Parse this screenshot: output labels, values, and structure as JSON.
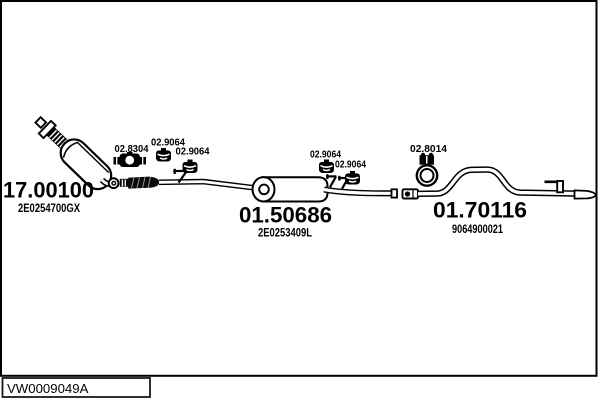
{
  "diagram": {
    "kind": "exhaust-system-parts-diagram",
    "background": "#ffffff",
    "line_color": "#000000",
    "vehicle_code": "VW0009049A",
    "parts": [
      {
        "number": "17.00100",
        "oem_ref": "2E0254700GX",
        "component": "catalytic-converter"
      },
      {
        "number": "01.50686",
        "oem_ref": "2E0253409L",
        "component": "centre-silencer"
      },
      {
        "number": "01.70116",
        "oem_ref": "9064900021",
        "component": "tail-pipe"
      }
    ],
    "fittings": [
      {
        "label": "02.8304",
        "type": "flange-clamp"
      },
      {
        "label": "02.9064",
        "type": "rubber-mounting"
      },
      {
        "label": "02.9064",
        "type": "rubber-mounting"
      },
      {
        "label": "02.9064",
        "type": "rubber-mounting"
      },
      {
        "label": "02.9064",
        "type": "rubber-mounting"
      },
      {
        "label": "02.8014",
        "type": "pipe-clamp"
      }
    ]
  }
}
